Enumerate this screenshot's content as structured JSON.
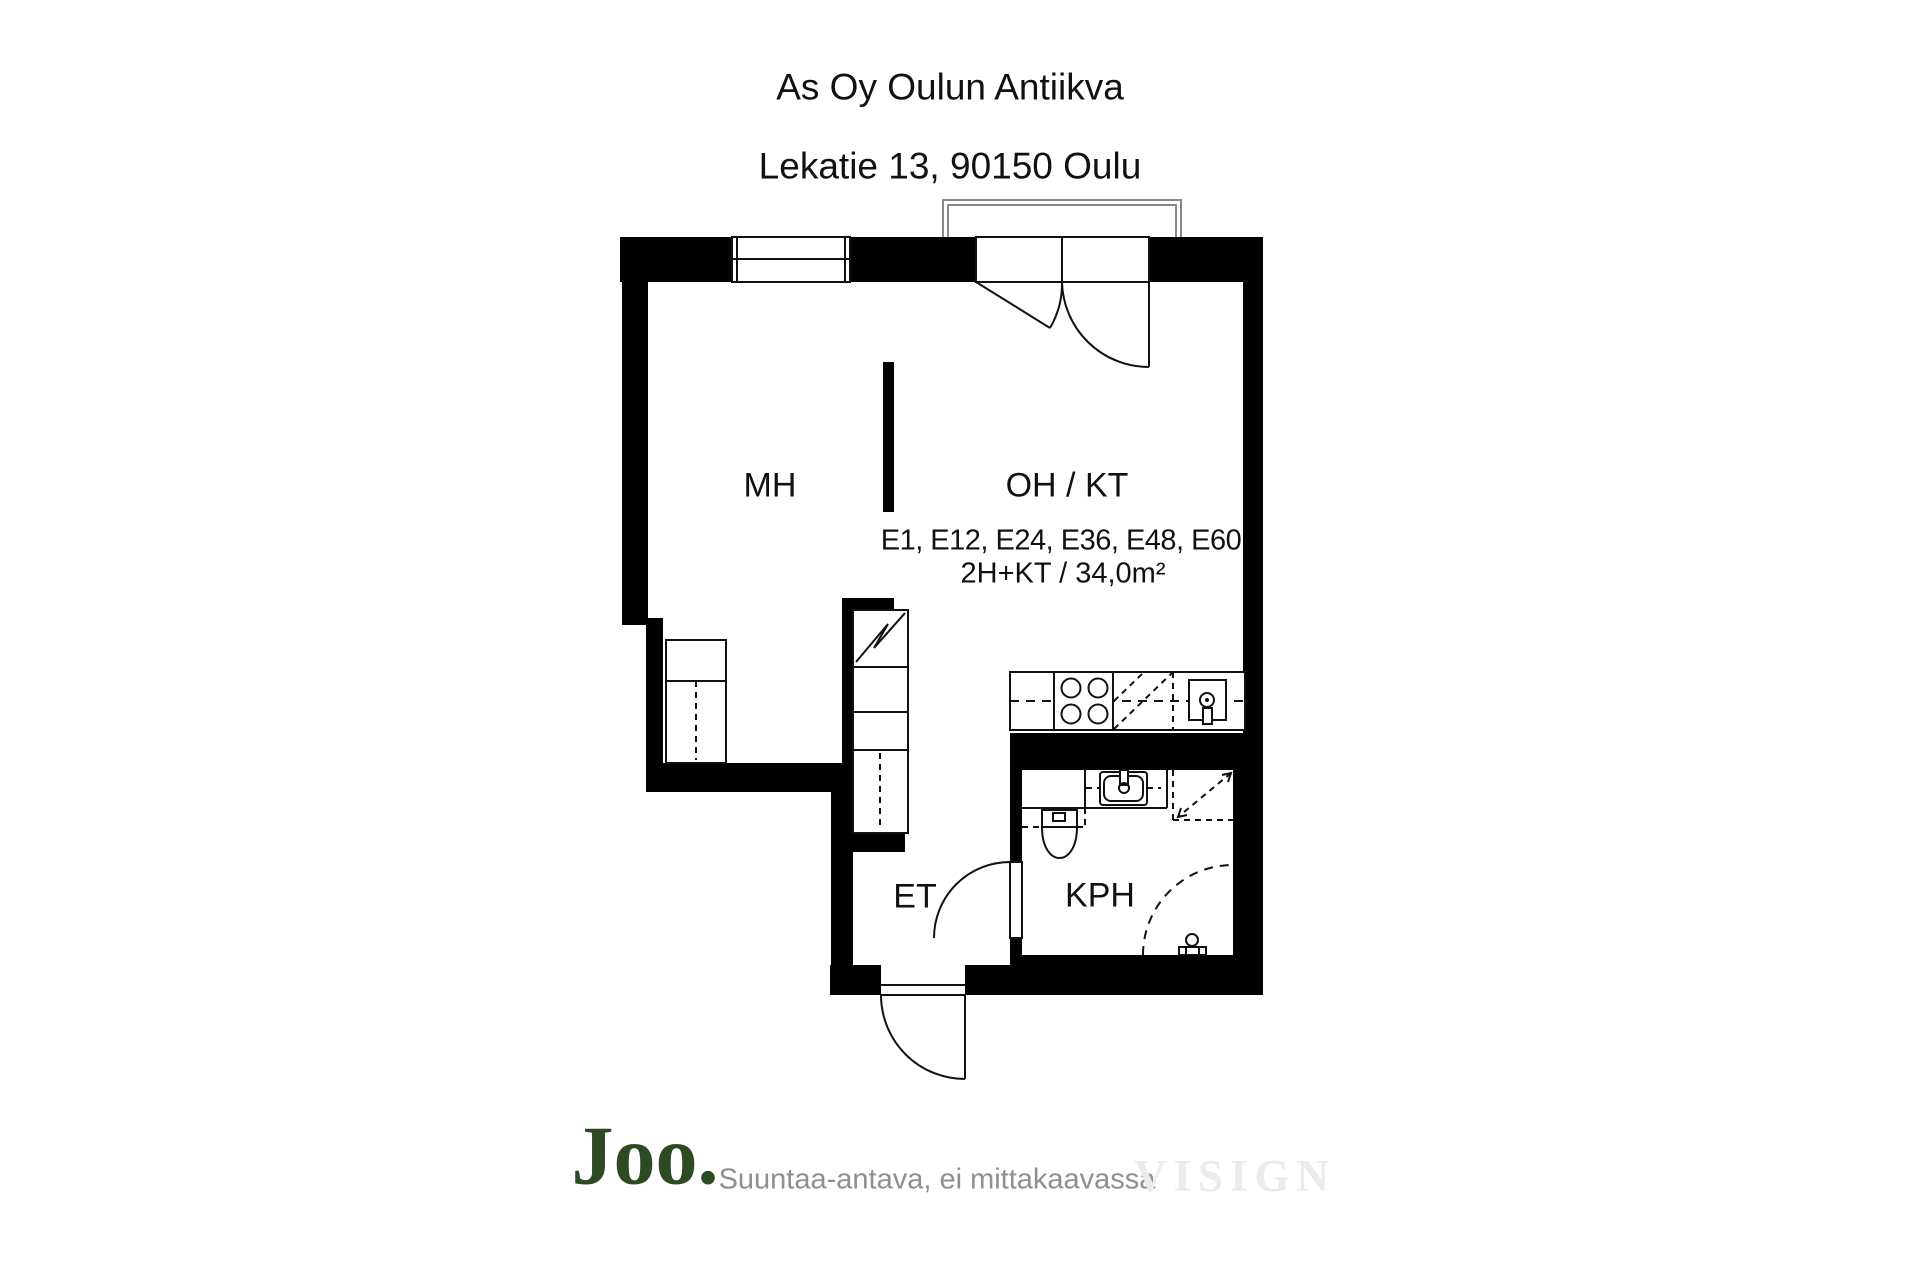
{
  "header": {
    "building_name": "As Oy Oulun Antiikva",
    "address": "Lekatie 13, 90150 Oulu"
  },
  "floorplan": {
    "labels": {
      "bedroom": "MH",
      "living_kitchen": "OH / KT",
      "hallway": "ET",
      "bathroom": "KPH"
    },
    "apartment_numbers": "E1, E12, E24, E36, E48, E60",
    "apartment_type": "2H+KT / 34,0m²"
  },
  "footer": {
    "logo": "Joo.",
    "disclaimer": "Suuntaa-antava, ei mittakaavassa",
    "watermark": "VISIGN"
  },
  "colors": {
    "wall_black": "#000000",
    "line_dark": "#111111",
    "balcony_line": "#888888",
    "logo_green": "#2e4a23",
    "disclaimer_gray": "#8f8f8f",
    "watermark_gray": "#edeae9",
    "background": "#ffffff"
  }
}
